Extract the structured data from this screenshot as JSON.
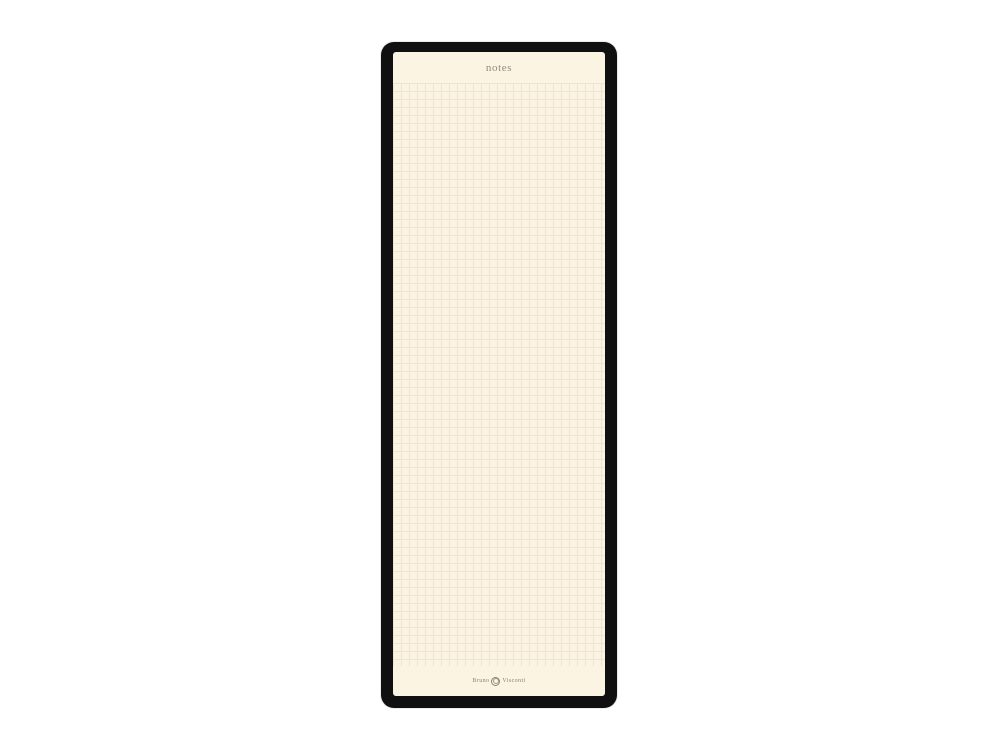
{
  "device": {
    "kind": "notepad-with-black-frame"
  },
  "page": {
    "title": "notes",
    "grid": {
      "cell_size_px": 8,
      "style": "square-grid"
    },
    "brand": {
      "name_left": "Bruno",
      "name_right": "Visconti",
      "emblem_icon": "circular-crest-icon"
    }
  },
  "colors": {
    "frame": "#101010",
    "paper": "#FBF4E3",
    "grid_line": "#F1E3D2",
    "title_text": "#8F8C82",
    "brand_text": "#8A8472",
    "canvas_bg": "#FFFFFF"
  }
}
